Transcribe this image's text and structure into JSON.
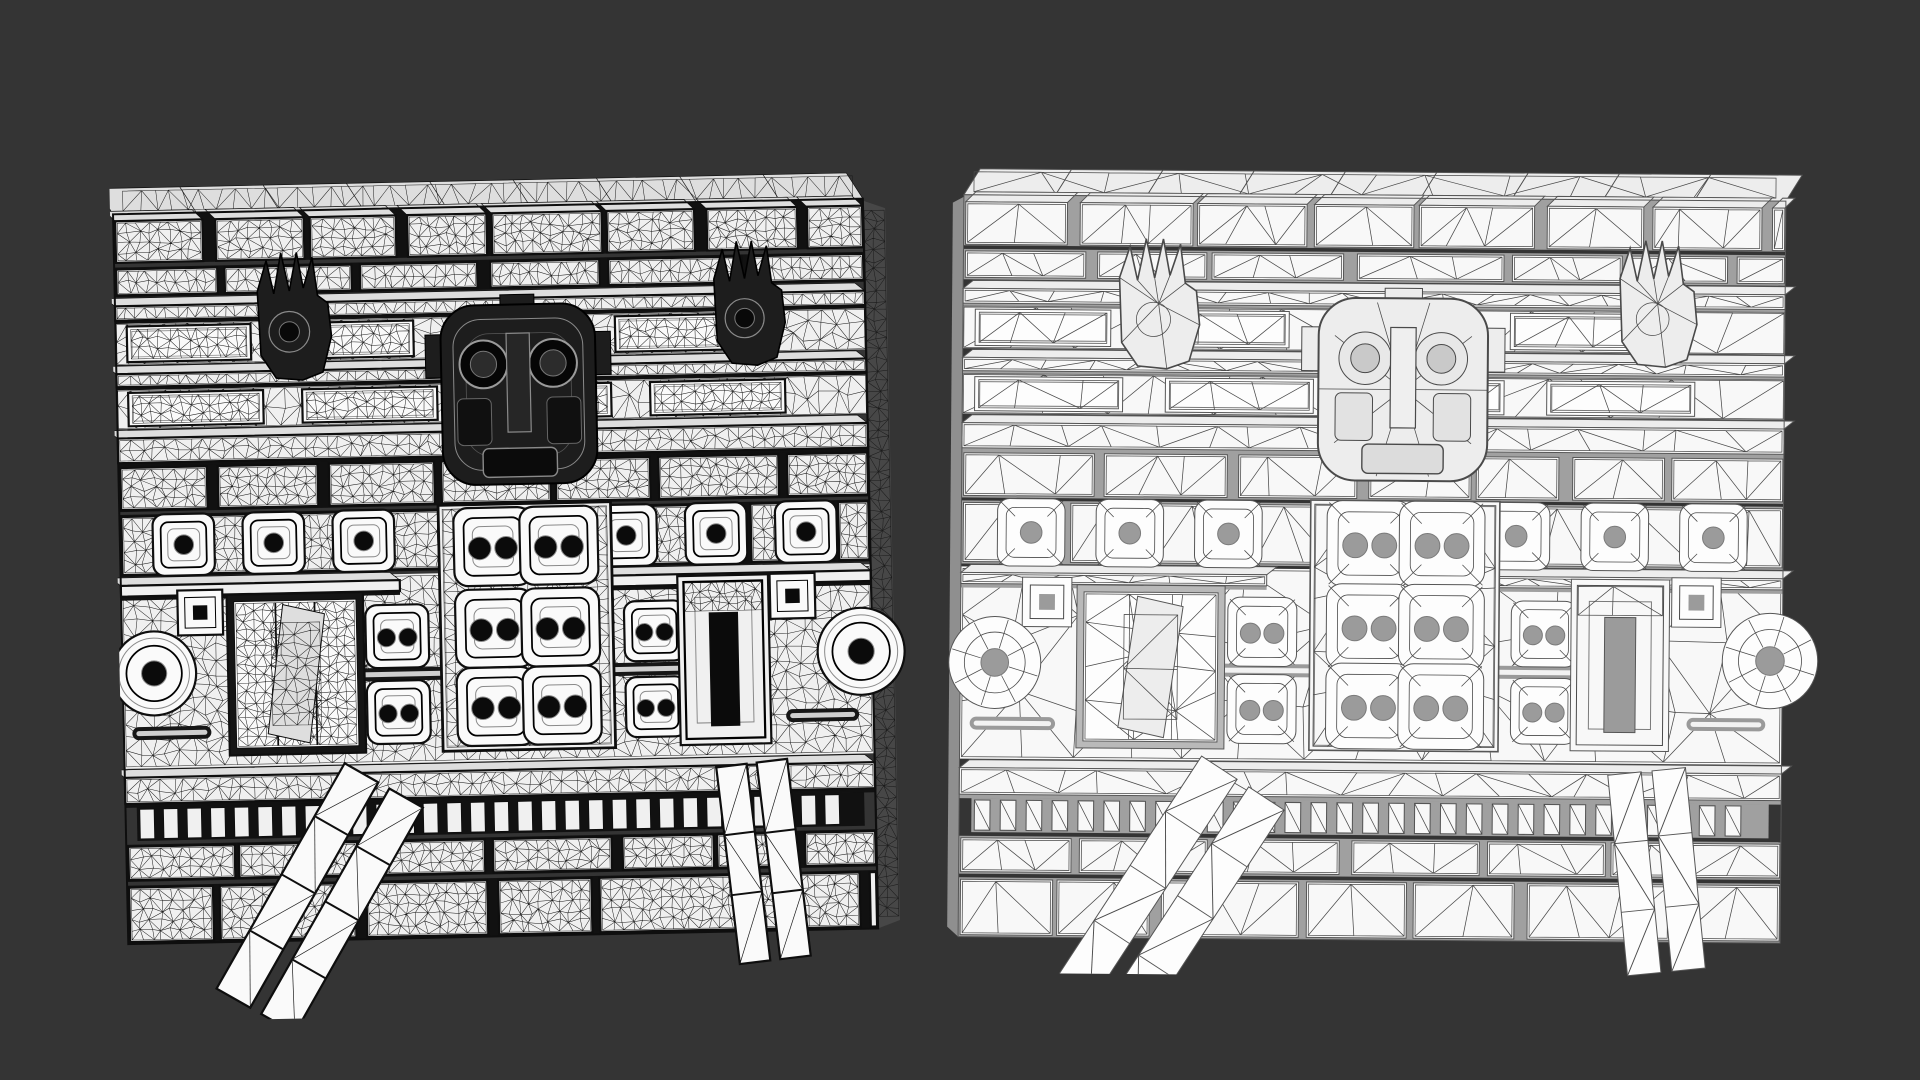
{
  "scene": {
    "background_color": "#343434",
    "canvas": {
      "width": 1920,
      "height": 1080
    },
    "subject": "aztec-temple-wall-mesh-comparison",
    "models": [
      {
        "style": "high_poly",
        "x": 118,
        "y": 168,
        "vw": 790,
        "vh": 846,
        "rot": -1.2,
        "front_w": 750,
        "front_h": 730,
        "side": "right",
        "side_w": 22,
        "cap_h": 26
      },
      {
        "style": "low_poly",
        "x": 948,
        "y": 160,
        "vw": 872,
        "vh": 816,
        "rot": 0.45,
        "front_w": 822,
        "front_h": 742,
        "side": "left",
        "side_w": 11,
        "cap_h": 26
      }
    ],
    "render_styles": {
      "high_poly": {
        "seed": 7,
        "dense": true,
        "cell": 10,
        "surface": "#f0f0f0",
        "panel": "#fafafa",
        "top": "#dedede",
        "gap": "#111111",
        "line": "#1a1a1a",
        "line_w": 0.5,
        "border": "#0e0e0e",
        "border_w": 2.2,
        "detail": "#8a8a8a",
        "sculpt": "#1d1d1d",
        "sculpt_edge": "#000000",
        "eye": "#0b0b0b",
        "side": "#474747",
        "pipe": "#161616",
        "pipe_core": "#cfcfcf"
      },
      "low_poly": {
        "seed": 11,
        "dense": false,
        "cell": 42,
        "surface": "#f8f8f8",
        "panel": "#fdfdfd",
        "top": "#ededed",
        "gap": "#a0a0a0",
        "line": "#4a4a4a",
        "line_w": 0.75,
        "border": "#565656",
        "border_w": 1.0,
        "detail": "#7a7a7a",
        "sculpt": "#ededed",
        "sculpt_edge": "#4a4a4a",
        "eye": "#9b9b9b",
        "side": "#8f8f8f",
        "pipe": "#9a9a9a",
        "pipe_core": "#f2f2f2"
      }
    },
    "wall_layout": {
      "bands": [
        {
          "type": "bricks",
          "y0": 0.0,
          "y1": 0.068,
          "bw": 0.118,
          "raised": true
        },
        {
          "type": "bricks",
          "y0": 0.073,
          "y1": 0.114,
          "bw": 0.15,
          "raised": false
        },
        {
          "type": "ledge",
          "y0": 0.118,
          "y1": 0.146,
          "x0": 0,
          "x1": 1
        },
        {
          "type": "panels",
          "y0": 0.15,
          "y1": 0.207,
          "pw": 0.165
        },
        {
          "type": "ledge",
          "y0": 0.211,
          "y1": 0.237,
          "x0": 0,
          "x1": 1
        },
        {
          "type": "panels",
          "y0": 0.241,
          "y1": 0.295,
          "pw": 0.18
        },
        {
          "type": "ledge",
          "y0": 0.299,
          "y1": 0.341,
          "x0": 0,
          "x1": 1,
          "big": true
        },
        {
          "type": "bricks",
          "y0": 0.345,
          "y1": 0.408,
          "bw": 0.13,
          "raised": false
        },
        {
          "type": "bricks",
          "y0": 0.412,
          "y1": 0.497,
          "bw": 0.112,
          "raised": false
        },
        {
          "type": "field",
          "y0": 0.501,
          "y1": 0.76
        },
        {
          "type": "ledge",
          "y0": 0.501,
          "y1": 0.524,
          "x0": 0,
          "x1": 0.372
        },
        {
          "type": "ledge",
          "y0": 0.501,
          "y1": 0.524,
          "x0": 0.545,
          "x1": 1
        },
        {
          "type": "ledge",
          "y0": 0.764,
          "y1": 0.808,
          "x0": 0,
          "x1": 1,
          "big": true
        },
        {
          "type": "slats",
          "y0": 0.813,
          "y1": 0.859,
          "x0": 0.015,
          "x1": 0.985
        },
        {
          "type": "bricks",
          "y0": 0.864,
          "y1": 0.915,
          "bw": 0.128,
          "raised": false
        },
        {
          "type": "bricks",
          "y0": 0.92,
          "y1": 1.0,
          "bw": 0.155,
          "raised": false
        }
      ],
      "eyes_row": {
        "y": 0.4545,
        "s": 0.082,
        "cx": [
          0.085,
          0.205,
          0.325,
          0.675,
          0.795,
          0.915
        ]
      },
      "center_panel": {
        "x0": 0.425,
        "x1": 0.655,
        "y0": 0.408,
        "y1": 0.745
      },
      "grid": {
        "cx": [
          0.497,
          0.585
        ],
        "cy": [
          0.466,
          0.578,
          0.685
        ],
        "s": 0.104
      },
      "flank_eyes": [
        {
          "cx": 0.367,
          "cy": 0.586,
          "s": 0.084
        },
        {
          "cx": 0.367,
          "cy": 0.69,
          "s": 0.084
        },
        {
          "cx": 0.71,
          "cy": 0.586,
          "s": 0.08
        },
        {
          "cx": 0.71,
          "cy": 0.69,
          "s": 0.08
        }
      ],
      "mask": {
        "cx": 0.536,
        "cy": 0.258,
        "w": 0.206,
        "h": 0.246
      },
      "claws": [
        {
          "cx": 0.238,
          "cy": 0.145,
          "w": 0.104,
          "h": 0.175
        },
        {
          "cx": 0.845,
          "cy": 0.14,
          "w": 0.1,
          "h": 0.17
        }
      ],
      "doors": [
        {
          "x0": 0.15,
          "x1": 0.313,
          "y0": 0.534,
          "y1": 0.735,
          "style": "planks"
        },
        {
          "x0": 0.75,
          "x1": 0.855,
          "y0": 0.52,
          "y1": 0.735,
          "style": "stepped"
        }
      ],
      "volutes": [
        {
          "cx": 0.042,
          "cy": 0.63,
          "r": 0.056
        },
        {
          "cx": 0.985,
          "cy": 0.62,
          "r": 0.058
        }
      ],
      "keys": [
        {
          "cx": 0.105,
          "cy": 0.548,
          "s": 0.06
        },
        {
          "cx": 0.895,
          "cy": 0.542,
          "s": 0.06
        }
      ],
      "pipes": [
        {
          "pts": [
            [
              0.318,
              0.638
            ],
            [
              0.425,
              0.638
            ]
          ]
        },
        {
          "pts": [
            [
              0.655,
              0.638
            ],
            [
              0.748,
              0.638
            ]
          ]
        },
        {
          "pts": [
            [
              0.02,
              0.712
            ],
            [
              0.108,
              0.712
            ]
          ]
        },
        {
          "pts": [
            [
              0.892,
              0.706
            ],
            [
              0.972,
              0.706
            ]
          ]
        }
      ],
      "legs": [
        {
          "top": [
            0.345,
            0.79
          ],
          "bot": [
            0.168,
            1.095
          ],
          "w": 0.12,
          "segs": 4
        },
        {
          "top": [
            0.836,
            0.77
          ],
          "bot": [
            0.862,
            1.04
          ],
          "w": 0.095,
          "segs": 3
        }
      ]
    }
  }
}
